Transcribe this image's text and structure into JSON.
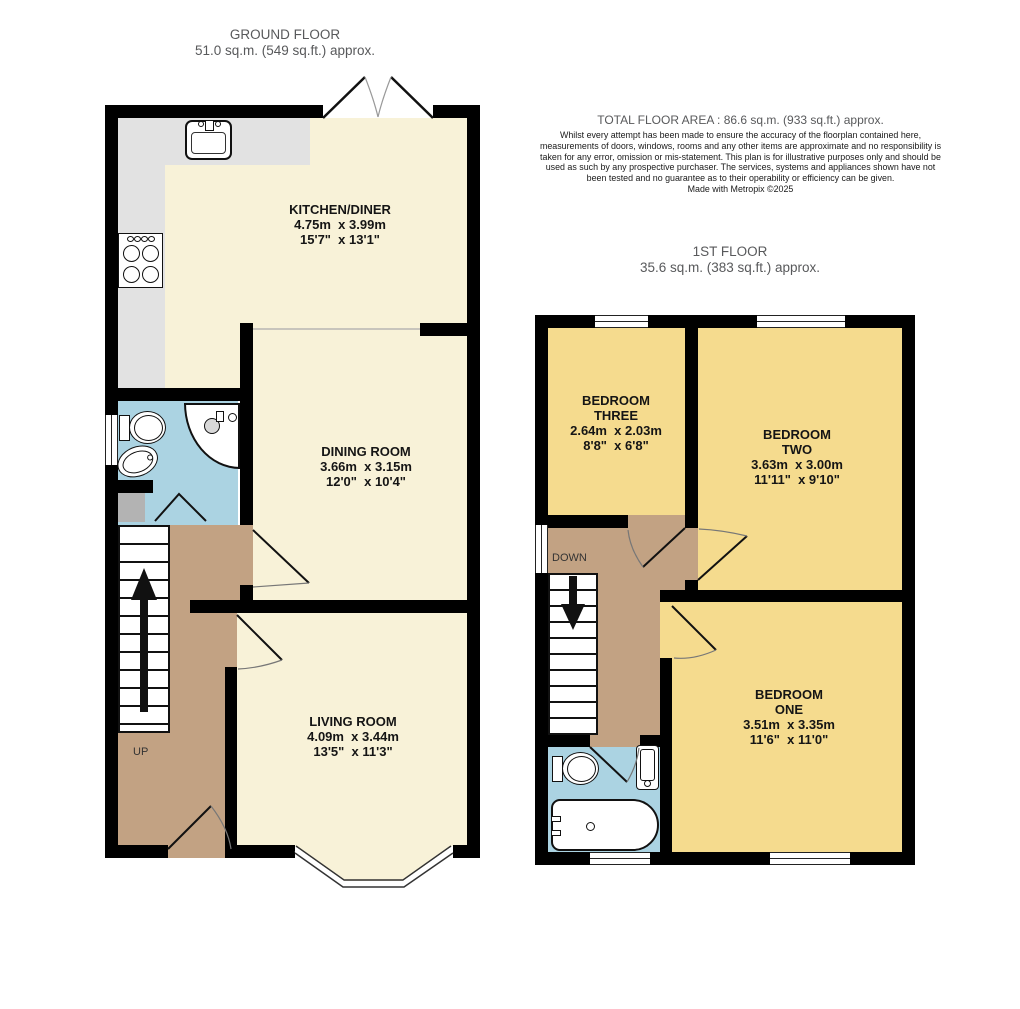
{
  "ground_floor": {
    "title": "GROUND FLOOR",
    "subtitle": "51.0 sq.m. (549 sq.ft.) approx.",
    "stairs_label": "UP",
    "rooms": {
      "kitchen_diner": {
        "name": "KITCHEN/DINER",
        "metric": "4.75m  x 3.99m",
        "imperial": "15'7\"  x 13'1\""
      },
      "dining_room": {
        "name": "DINING ROOM",
        "metric": "3.66m  x 3.15m",
        "imperial": "12'0\"  x 10'4\""
      },
      "living_room": {
        "name": "LIVING ROOM",
        "metric": "4.09m  x 3.44m",
        "imperial": "13'5\"  x 11'3\""
      }
    }
  },
  "first_floor": {
    "title": "1ST FLOOR",
    "subtitle": "35.6 sq.m. (383 sq.ft.) approx.",
    "stairs_label": "DOWN",
    "rooms": {
      "bedroom_three": {
        "line1": "BEDROOM",
        "line2": "THREE",
        "metric": "2.64m  x 2.03m",
        "imperial": "8'8\"  x 6'8\""
      },
      "bedroom_two": {
        "line1": "BEDROOM",
        "line2": "TWO",
        "metric": "3.63m  x 3.00m",
        "imperial": "11'11\"  x 9'10\""
      },
      "bedroom_one": {
        "line1": "BEDROOM",
        "line2": "ONE",
        "metric": "3.51m  x 3.35m",
        "imperial": "11'6\"  x 11'0\""
      }
    }
  },
  "summary": {
    "total_area": "TOTAL FLOOR AREA : 86.6 sq.m. (933 sq.ft.) approx.",
    "disclaimer": "Whilst every attempt has been made to ensure the accuracy of the floorplan contained here, measurements of doors, windows, rooms and any other items are approximate and no responsibility is taken for any error, omission or mis-statement. This plan is for illustrative purposes only and should be used as such by any prospective purchaser. The services, systems and appliances shown have not been tested and no guarantee as to their operability or efficiency can be given.",
    "credit": "Made with Metropix ©2025"
  },
  "colors": {
    "room_cream": "#f8f2d8",
    "room_gold": "#f5db8e",
    "hall_tan": "#c2a283",
    "wet_blue": "#abd3e2",
    "counter_grey": "#e2e2e2",
    "wall_black": "#000000"
  }
}
